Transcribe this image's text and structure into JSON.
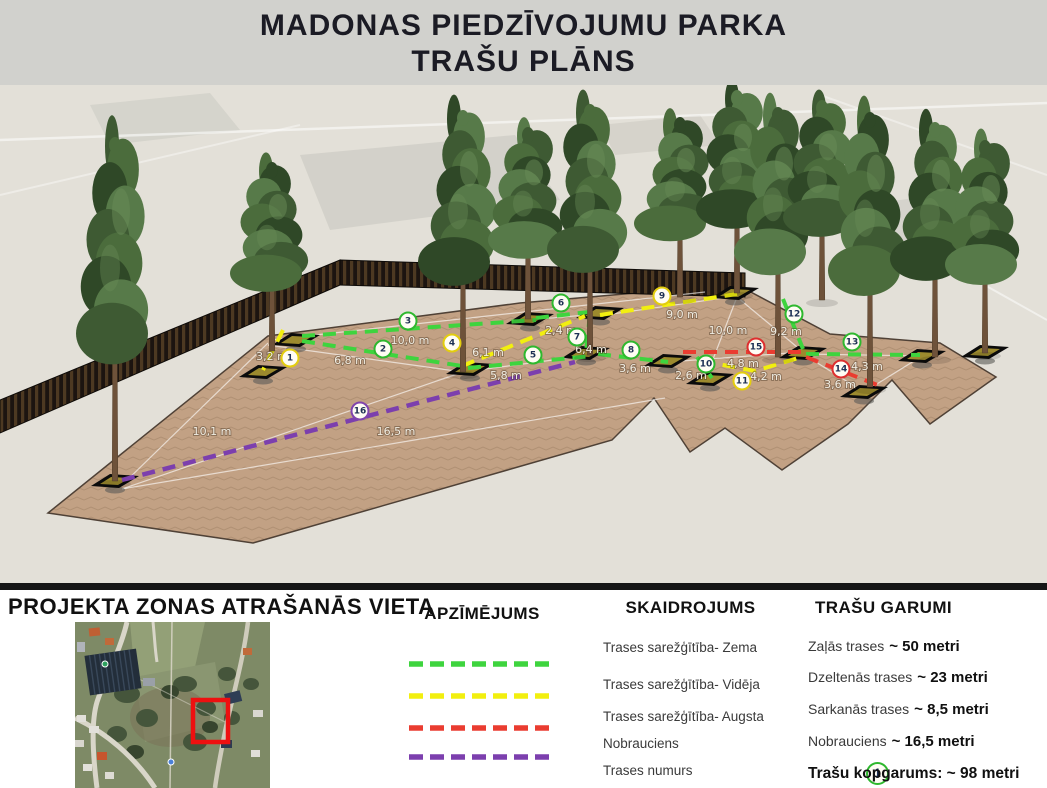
{
  "title": {
    "line1": "MADONAS PIEDZĪVOJUMU PARKA",
    "line2": "TRAŠU PLĀNS"
  },
  "colors": {
    "track_green": "#3ed43e",
    "track_yellow": "#f2ef0f",
    "track_red": "#ea3c30",
    "track_purple": "#7c3fae",
    "ring_green": "#2eb82e",
    "ring_yellow": "#e3cd0e",
    "ring_red": "#dd2f2f",
    "ring_purple": "#8044ad",
    "project_marker_red": "#ee1010"
  },
  "scene": {
    "markers": [
      {
        "n": "1",
        "ring": "#e3cd0e",
        "x": 290,
        "y": 273
      },
      {
        "n": "2",
        "ring": "#2eb82e",
        "x": 383,
        "y": 264
      },
      {
        "n": "3",
        "ring": "#2eb82e",
        "x": 408,
        "y": 236
      },
      {
        "n": "4",
        "ring": "#e3cd0e",
        "x": 452,
        "y": 258
      },
      {
        "n": "5",
        "ring": "#2eb82e",
        "x": 533,
        "y": 270
      },
      {
        "n": "6",
        "ring": "#2eb82e",
        "x": 561,
        "y": 218
      },
      {
        "n": "7",
        "ring": "#2eb82e",
        "x": 577,
        "y": 252
      },
      {
        "n": "8",
        "ring": "#2eb82e",
        "x": 631,
        "y": 265
      },
      {
        "n": "9",
        "ring": "#e3cd0e",
        "x": 662,
        "y": 211
      },
      {
        "n": "10",
        "ring": "#2eb82e",
        "x": 706,
        "y": 279
      },
      {
        "n": "11",
        "ring": "#e3cd0e",
        "x": 742,
        "y": 296
      },
      {
        "n": "12",
        "ring": "#2eb82e",
        "x": 794,
        "y": 229
      },
      {
        "n": "13",
        "ring": "#2eb82e",
        "x": 852,
        "y": 257
      },
      {
        "n": "14",
        "ring": "#dd2f2f",
        "x": 841,
        "y": 284
      },
      {
        "n": "15",
        "ring": "#dd2f2f",
        "x": 756,
        "y": 262
      },
      {
        "n": "16",
        "ring": "#8044ad",
        "x": 360,
        "y": 326
      }
    ],
    "measurements": [
      {
        "text": "3,2 m",
        "x": 272,
        "y": 272
      },
      {
        "text": "10,0 m",
        "x": 410,
        "y": 256
      },
      {
        "text": "6,8 m",
        "x": 350,
        "y": 276
      },
      {
        "text": "6,1 m",
        "x": 488,
        "y": 268
      },
      {
        "text": "5,8 m",
        "x": 506,
        "y": 291
      },
      {
        "text": "2,4 m",
        "x": 561,
        "y": 246
      },
      {
        "text": "6,4 m",
        "x": 591,
        "y": 265
      },
      {
        "text": "3,6 m",
        "x": 635,
        "y": 284
      },
      {
        "text": "9,0 m",
        "x": 682,
        "y": 230
      },
      {
        "text": "10,0 m",
        "x": 728,
        "y": 246
      },
      {
        "text": "9,2 m",
        "x": 786,
        "y": 247
      },
      {
        "text": "2,6 m",
        "x": 691,
        "y": 291
      },
      {
        "text": "4,8 m",
        "x": 743,
        "y": 279
      },
      {
        "text": "4,2 m",
        "x": 766,
        "y": 292
      },
      {
        "text": "4,3 m",
        "x": 867,
        "y": 282
      },
      {
        "text": "3,6 m",
        "x": 840,
        "y": 300
      },
      {
        "text": "10,1 m",
        "x": 212,
        "y": 347
      },
      {
        "text": "16,5 m",
        "x": 396,
        "y": 347
      }
    ]
  },
  "location": {
    "heading": "PROJEKTA ZONAS ATRAŠANĀS VIETA"
  },
  "legend": {
    "heading": "APZĪMĒJUMS",
    "swatches": [
      "#3ed43e",
      "#f2ef0f",
      "#ea3c30",
      "#7c3fae"
    ],
    "marker_label": "1"
  },
  "explanation": {
    "heading": "SKAIDROJUMS",
    "items": [
      "Trases sarežģītība- Zema",
      "Trases sarežģītība- Vidēja",
      "Trases sarežģītība- Augsta",
      "Nobrauciens",
      "Trases numurs"
    ]
  },
  "lengths": {
    "heading": "TRAŠU GARUMI",
    "items": [
      {
        "label": "Zaļās trases",
        "value": "~ 50 metri"
      },
      {
        "label": "Dzeltenās trases",
        "value": "~ 23 metri"
      },
      {
        "label": "Sarkanās trases",
        "value": "~ 8,5 metri"
      },
      {
        "label": "Nobrauciens",
        "value": "~ 16,5 metri"
      }
    ],
    "total": "Trašu kopgarums: ~ 98 metri"
  }
}
